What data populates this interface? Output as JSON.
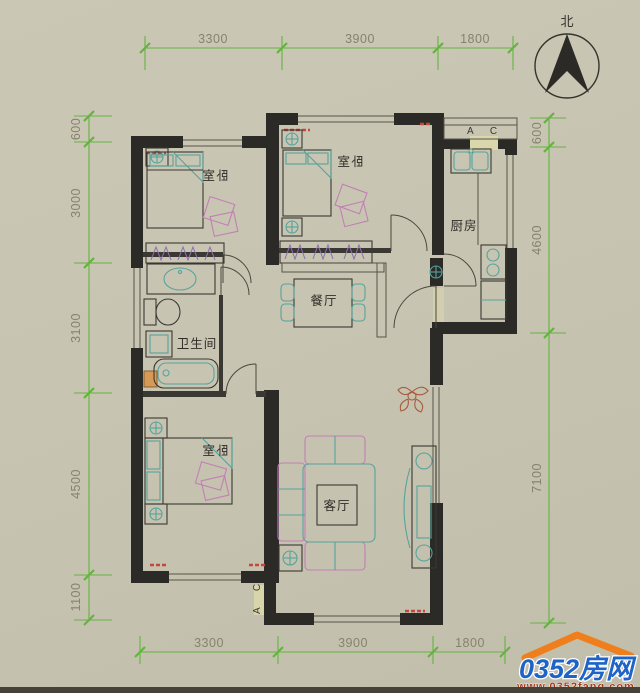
{
  "colors": {
    "paper": "#c8c4b2",
    "wall": "#2b2a26",
    "dimension_line": "#63b43f",
    "dimension_text": "#85826d",
    "furniture_teal": "#55a49c",
    "furniture_pink": "#c27fb5",
    "window_red": "#c5473c",
    "brand_blue": "#1d63c8",
    "brand_orange": "#ef7f1c",
    "url_red": "#9c3b22"
  },
  "compass": {
    "north_label": "北"
  },
  "rooms": {
    "bedroom_top_left": "卧室",
    "bedroom_top_middle": "卧室",
    "bedroom_bottom_left": "卧室",
    "kitchen": "厨房",
    "dining": "餐厅",
    "bathroom": "卫生间",
    "living": "客厅"
  },
  "door_labels": {
    "kitchen_balcony": "A C",
    "living_balcony": "A C"
  },
  "dimensions": {
    "top": [
      "3300",
      "3900",
      "1800"
    ],
    "bottom": [
      "3300",
      "3900",
      "1800"
    ],
    "left": [
      "600",
      "3000",
      "3100",
      "4500",
      "1100"
    ],
    "right": [
      "600",
      "4600",
      "7100"
    ]
  },
  "watermark": {
    "brand": "0352房网",
    "url": "www.0352fang.com"
  }
}
